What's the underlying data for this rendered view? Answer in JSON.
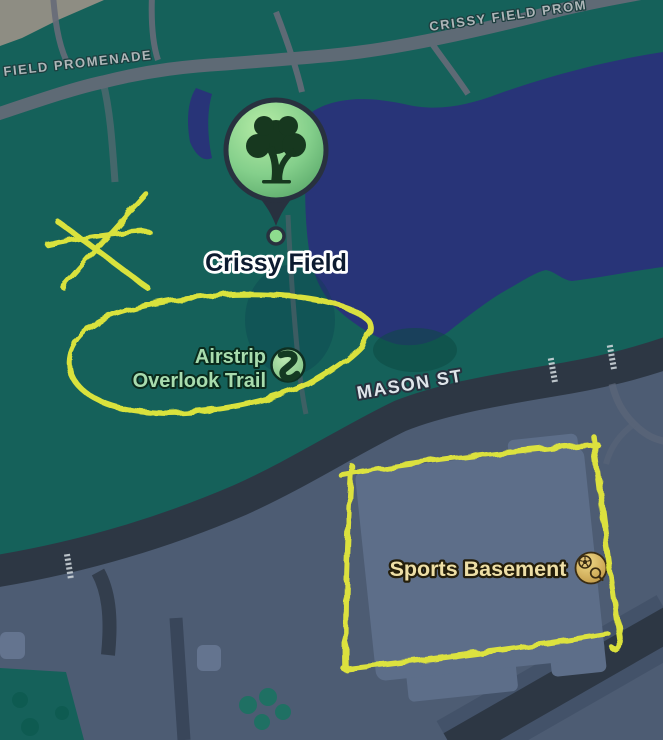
{
  "map": {
    "street_labels": {
      "promenade_left": "FIELD PROMENADE",
      "promenade_right": "CRISSY FIELD PROM",
      "mason": "MASON ST"
    },
    "pois": {
      "crissy_field": {
        "label": "Crissy Field",
        "icon": "tree-pin"
      },
      "airstrip_overlook": {
        "line1": "Airstrip",
        "line2": "Overlook Trail",
        "icon": "trail"
      },
      "sports_basement": {
        "label": "Sports Basement",
        "icon": "soccer-and-tennis"
      }
    },
    "annotations": {
      "style": "hand-drawn yellow marker",
      "shapes": [
        "asterisk-star",
        "oval-around-airstrip-overlook-trail",
        "rectangle-around-sports-basement"
      ]
    },
    "colors": {
      "water": "#283478",
      "park": "#15615a",
      "urban": "#4d5c73",
      "road": "#2d3744",
      "building": "#5d6e89",
      "sand": "#8e8d83",
      "path_gray": "#676b78",
      "annotation_yellow": "#e2e83e",
      "pin_green": "#8edc8e",
      "pin_ring": "#28313f",
      "trail_label_green": "#a8dcae",
      "store_label_tan": "#eedfa6",
      "street_label_white": "#dfe5ea",
      "promenade_label_gray": "#aeb6b8"
    }
  }
}
